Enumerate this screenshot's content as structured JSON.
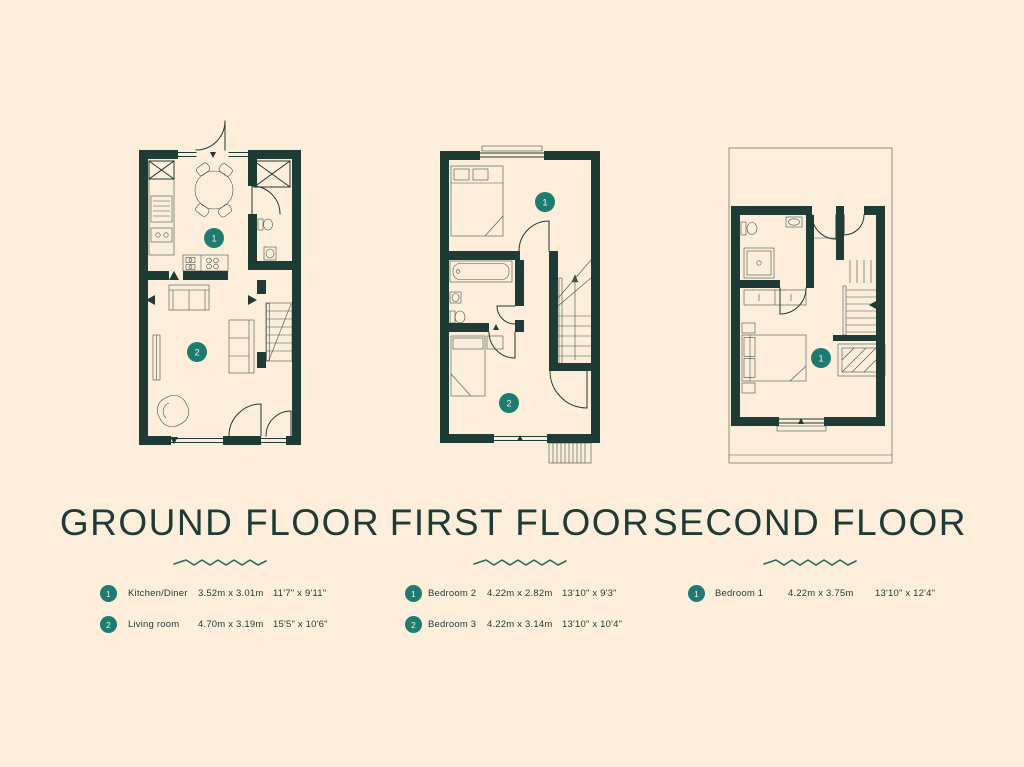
{
  "palette": {
    "bg": "#fdeedc",
    "wall": "#1e3b35",
    "accent": "#1e7b70",
    "text": "#1e3b35",
    "zigzag": "#266a5e"
  },
  "floors": [
    {
      "title": "GROUND FLOOR",
      "rooms": [
        {
          "num": "1",
          "name": "Kitchen/Diner",
          "metric": "3.52m x 3.01m",
          "imperial": "11'7\" x 9'11\""
        },
        {
          "num": "2",
          "name": "Living room",
          "metric": "4.70m x 3.19m",
          "imperial": "15'5\" x 10'6\""
        }
      ]
    },
    {
      "title": "FIRST FLOOR",
      "rooms": [
        {
          "num": "1",
          "name": "Bedroom 2",
          "metric": "4.22m x 2.82m",
          "imperial": "13'10\" x 9'3\""
        },
        {
          "num": "2",
          "name": "Bedroom 3",
          "metric": "4.22m x 3.14m",
          "imperial": "13'10\" x 10'4\""
        }
      ]
    },
    {
      "title": "SECOND FLOOR",
      "rooms": [
        {
          "num": "1",
          "name": "Bedroom 1",
          "metric": "4.22m x 3.75m",
          "imperial": "13'10\" x 12'4\""
        }
      ]
    }
  ]
}
